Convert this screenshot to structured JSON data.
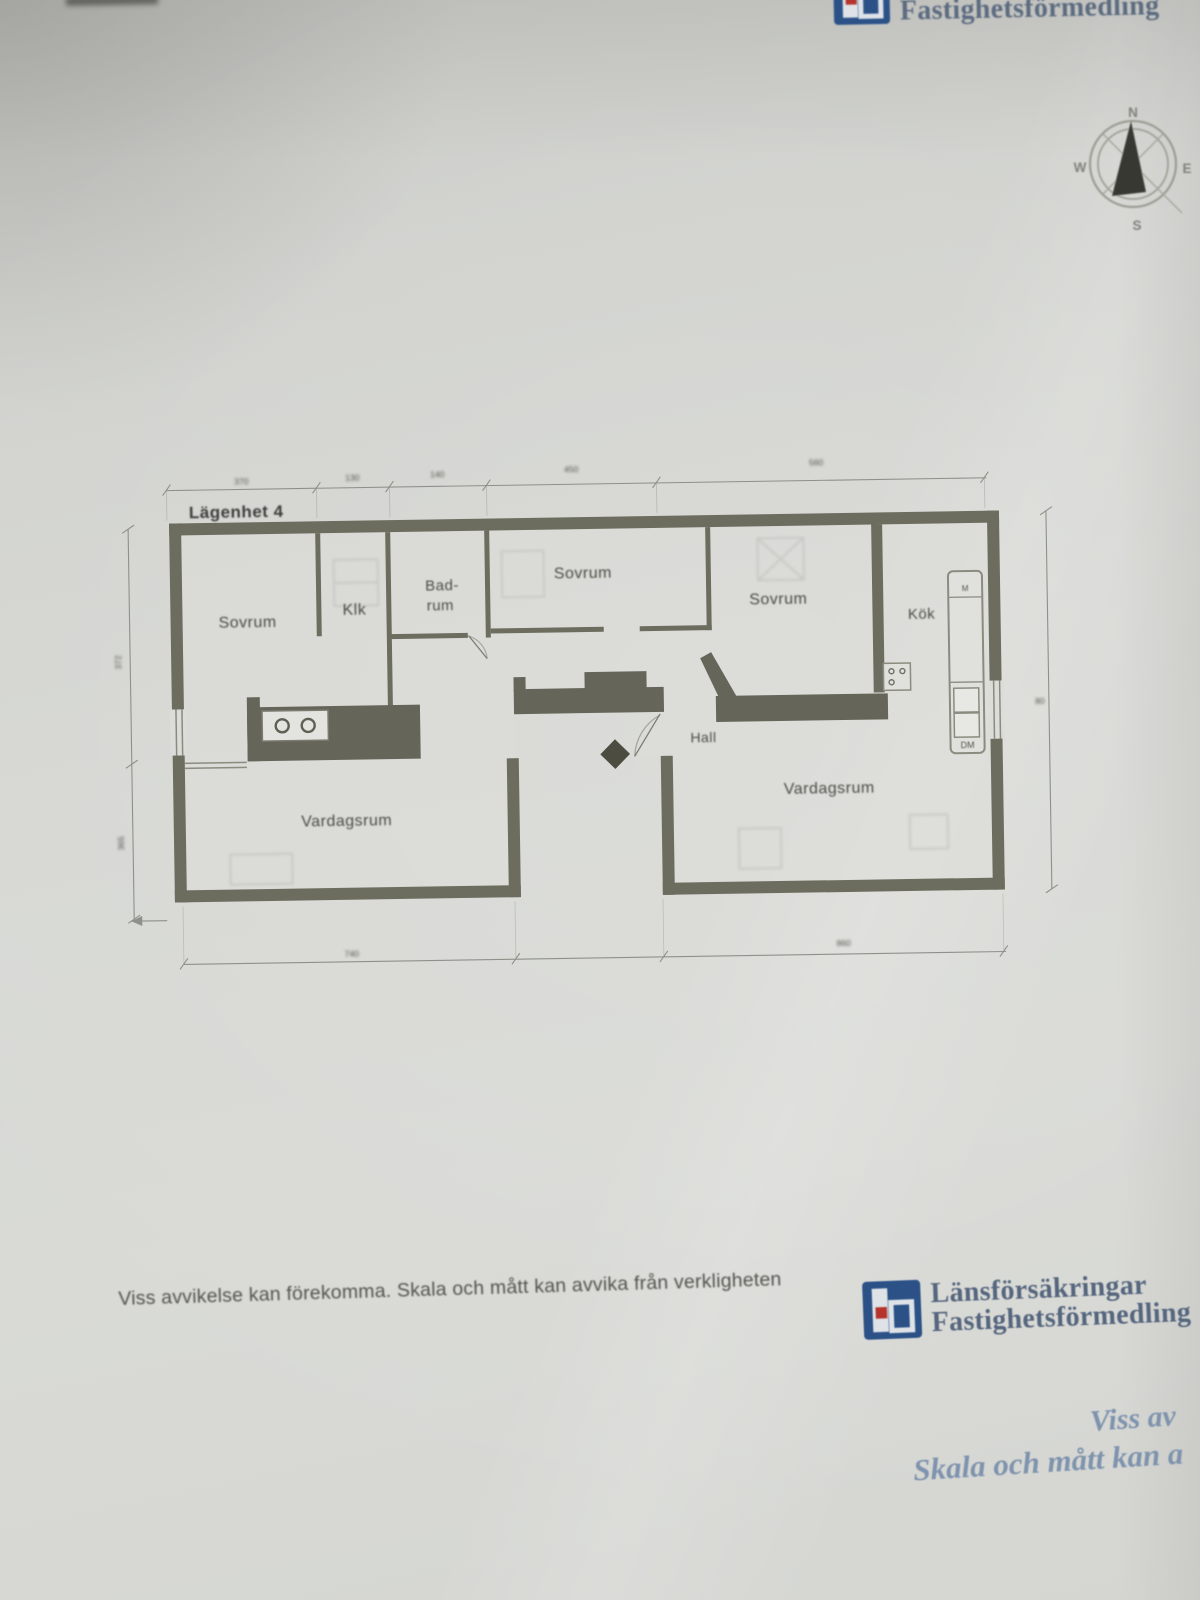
{
  "header": {
    "logo": {
      "line1": "Länsförsäkringar",
      "line2": "Fastighetsförmedling"
    }
  },
  "compass": {
    "n": "N",
    "e": "E",
    "s": "S",
    "w": "W"
  },
  "plan": {
    "title": "Lägenhet 4",
    "rooms": {
      "sovrum_left": "Sovrum",
      "klk": "Klk",
      "badrum_line1": "Bad-",
      "badrum_line2": "rum",
      "sovrum_mid": "Sovrum",
      "sovrum_right": "Sovrum",
      "kok_right": "Kök",
      "hall": "Hall",
      "vardagsrum_left": "Vardagsrum",
      "vardagsrum_right": "Vardagsrum"
    },
    "labels": {
      "m": "M",
      "dm": "DM"
    },
    "dimensions": {
      "top": [
        "370",
        "130",
        "140",
        "450",
        "560"
      ],
      "bottom": [
        "740",
        "860"
      ],
      "left": [
        "372",
        "365"
      ],
      "right": [
        "80"
      ]
    }
  },
  "footer": {
    "disclaimer": "Viss avvikelse kan förekomma. Skala och mått kan avvika från verkligheten",
    "logo": {
      "line1": "Länsförsäkringar",
      "line2": "Fastighetsförmedling"
    },
    "note": {
      "line1": "Viss av",
      "line2": "Skala och mått kan a"
    }
  },
  "colors": {
    "wall": "#6c6c5f",
    "fixture": "#65655a",
    "paper": "#d6d7d3",
    "logo_blue": "#2b5187",
    "logo_red": "#b5342c",
    "logo_text": "#5c6b80",
    "handwriting_blue": "#7e93ad"
  }
}
